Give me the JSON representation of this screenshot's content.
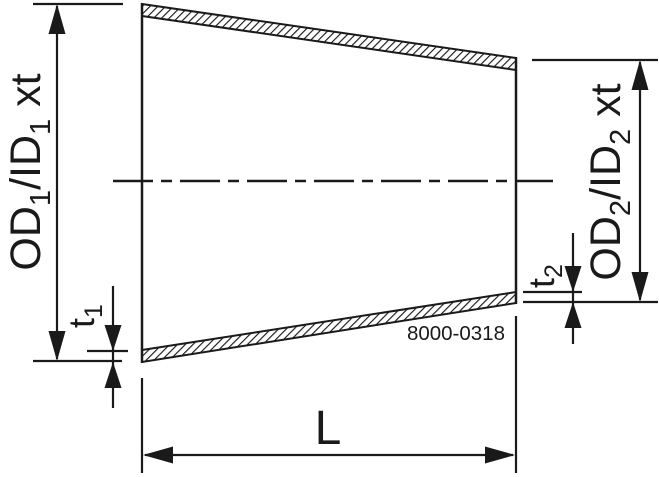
{
  "diagram": {
    "description": "Concentric reducer technical drawing",
    "colors": {
      "ink": "#1a1a1a",
      "background": "#ffffff"
    },
    "labels": {
      "dim_left": {
        "prefix": "OD",
        "sub1": "1",
        "mid": "/ID",
        "sub2": "1",
        "suffix": " xt"
      },
      "dim_right": {
        "prefix": "OD",
        "sub1": "2",
        "mid": "/ID",
        "sub2": "2",
        "suffix": " xt"
      },
      "thickness_left": {
        "prefix": "t",
        "sub": "1"
      },
      "thickness_right": {
        "prefix": "t",
        "sub": "2"
      },
      "length": "L",
      "drawing_number": "8000-0318"
    }
  }
}
